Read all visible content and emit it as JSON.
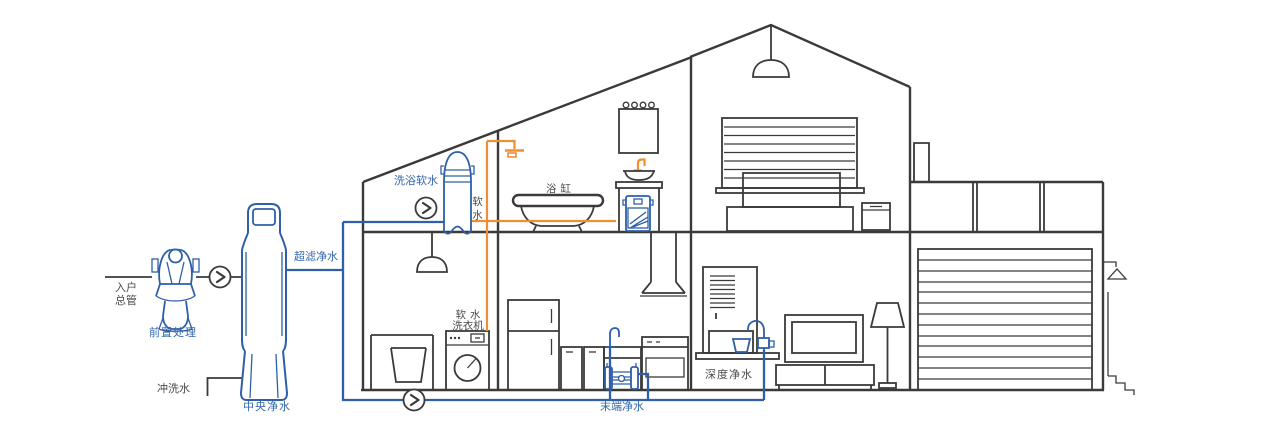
{
  "diagram_type": "whole-house water purification system cutaway",
  "colors": {
    "pipe_blue": "#2e5fa8",
    "pipe_orange": "#ef8f35",
    "outline_dark": "#3b3a39",
    "label_blue": "#3166ad",
    "label_dark": "#4a4a48",
    "background": "#ffffff"
  },
  "icons": {
    "flow_arrow": "›"
  },
  "labels": {
    "main_inlet": {
      "line1": "入户",
      "line2": "总管"
    },
    "pre_treatment": "前置处理",
    "central_purifier": "中央净水",
    "flush_water": "冲洗水",
    "ultrafiltration": "超滤净水",
    "bath_softener": "洗浴软水",
    "soft_water": "软水",
    "bathtub": "浴缸",
    "soft_washer": {
      "line1": "软水",
      "line2": "洗衣机"
    },
    "terminal_purifier": "末端净水",
    "deep_purifier": "深度净水"
  }
}
